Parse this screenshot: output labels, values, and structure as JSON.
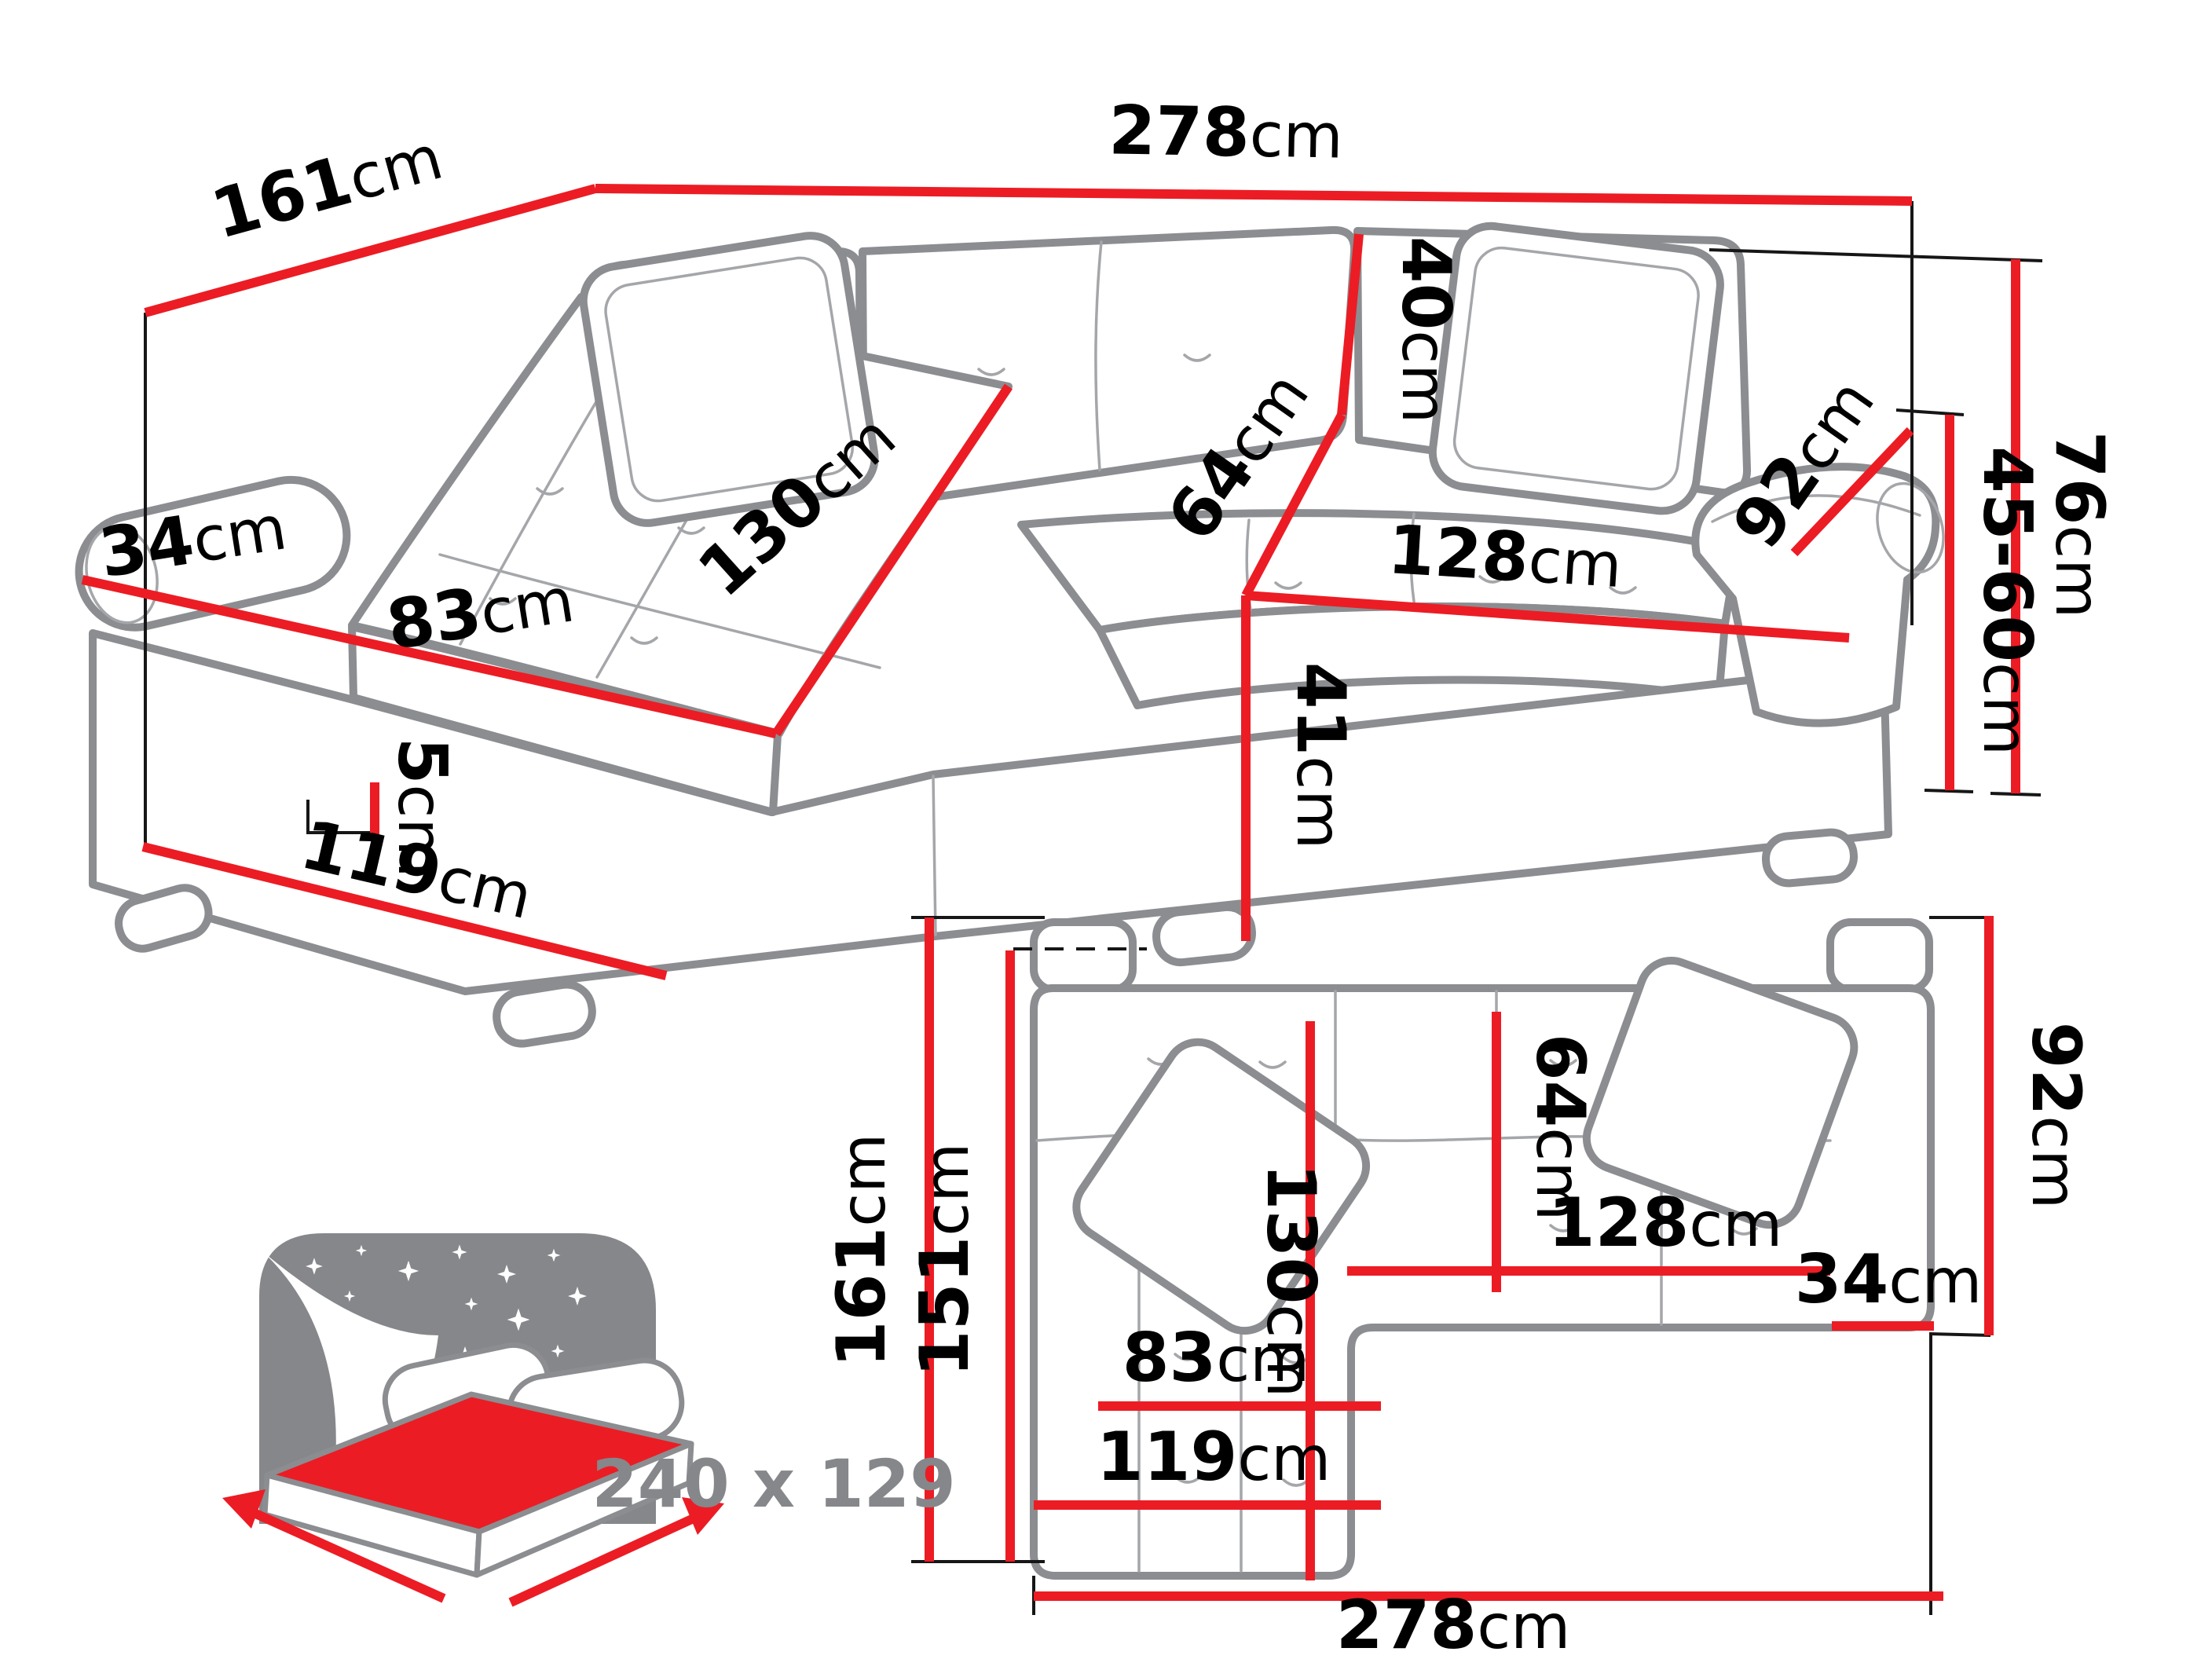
{
  "image_type": "furniture dimension diagram",
  "product": "corner sofa bed with chaise longue",
  "colors": {
    "dimension_line": "#ec1c24",
    "sofa_outline": "#8b8d90",
    "label_text": "#000000",
    "sleeping_size_text": "#85878a",
    "background": "#ffffff"
  },
  "perspective_view": {
    "dims": {
      "total_width": {
        "v": "278",
        "u": "cm"
      },
      "total_depth": {
        "v": "161",
        "u": "cm"
      },
      "left_armrest_width": {
        "v": "34",
        "u": "cm"
      },
      "chaise_seat_width": {
        "v": "83",
        "u": "cm"
      },
      "chaise_length": {
        "v": "130",
        "u": "cm"
      },
      "backrest_height": {
        "v": "40",
        "u": "cm"
      },
      "seat_depth": {
        "v": "64",
        "u": "cm"
      },
      "seat_width": {
        "v": "128",
        "u": "cm"
      },
      "seat_front_height": {
        "v": "41",
        "u": "cm"
      },
      "right_armrest_length": {
        "v": "92",
        "u": "cm"
      },
      "seat_height_range": {
        "v": "45-60",
        "u": "cm"
      },
      "total_height": {
        "v": "76",
        "u": "cm"
      },
      "leg_height": {
        "v": "5",
        "u": "cm"
      },
      "chaise_front_width": {
        "v": "119",
        "u": "cm"
      }
    }
  },
  "plan_view": {
    "dims": {
      "total_depth": {
        "v": "161",
        "u": "cm"
      },
      "depth_without_armrest": {
        "v": "151",
        "u": "cm"
      },
      "chaise_length": {
        "v": "130",
        "u": "cm"
      },
      "seat_depth": {
        "v": "64",
        "u": "cm"
      },
      "seat_width": {
        "v": "128",
        "u": "cm"
      },
      "right_armrest_width": {
        "v": "34",
        "u": "cm"
      },
      "right_armrest_length": {
        "v": "92",
        "u": "cm"
      },
      "chaise_seat_width": {
        "v": "83",
        "u": "cm"
      },
      "chaise_front_width": {
        "v": "119",
        "u": "cm"
      },
      "total_width": {
        "v": "278",
        "u": "cm"
      }
    }
  },
  "sleeping_area": {
    "label": "240 x 129"
  }
}
